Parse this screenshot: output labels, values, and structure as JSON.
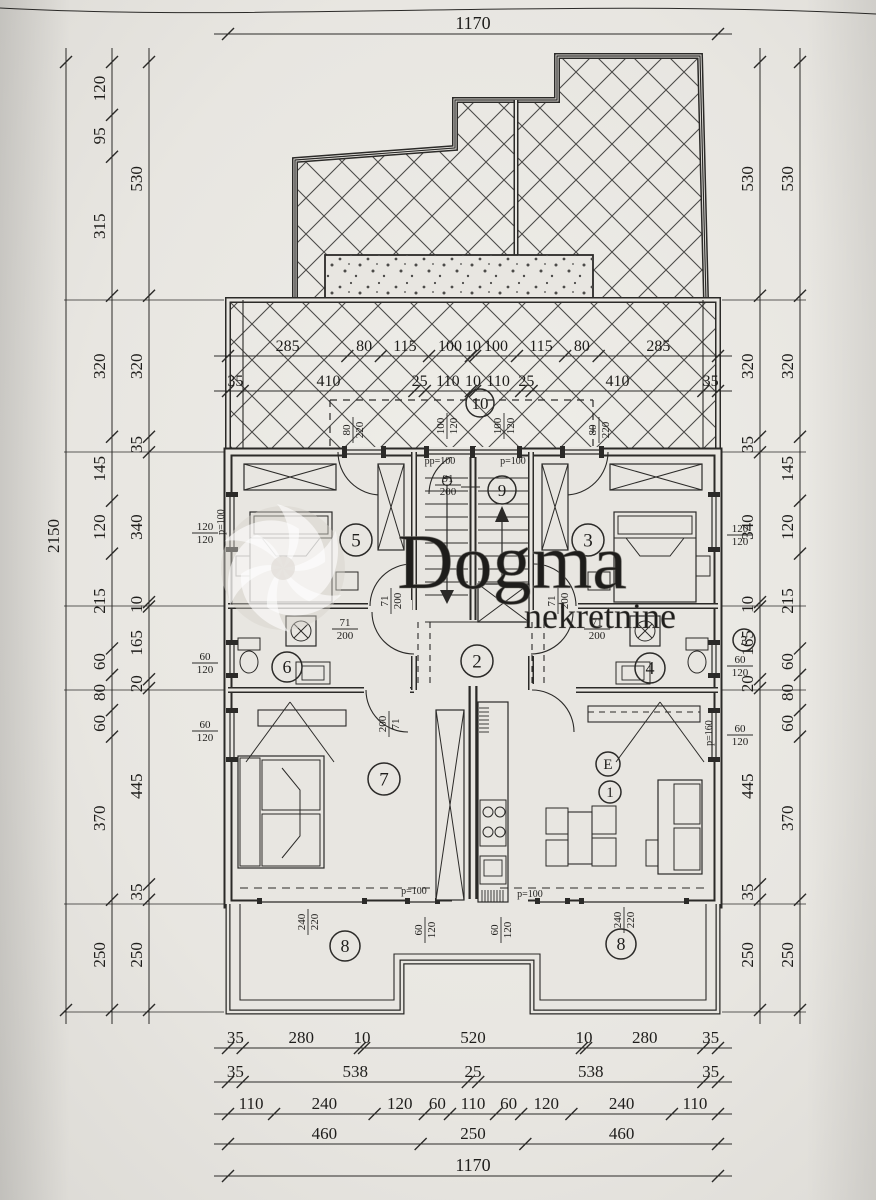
{
  "colors": {
    "paper": "#e8e6e1",
    "paper_light": "#efeee9",
    "ink": "#2b2a28",
    "hatch": "#4c4b49"
  },
  "dimensions": {
    "top_row": [
      "1170"
    ],
    "left_outer": [
      "2150"
    ],
    "left_middle": [
      "120",
      "95",
      "315",
      "320",
      "145",
      "120",
      "215",
      "60",
      "80",
      "60",
      "370",
      "250"
    ],
    "left_inner": [
      "530",
      "320",
      "35",
      "340",
      "10",
      "165",
      "20",
      "445",
      "35",
      "250"
    ],
    "right_inner": [
      "530",
      "320",
      "35",
      "340",
      "10",
      "165",
      "20",
      "445",
      "35",
      "250"
    ],
    "right_outer": [
      "530",
      "320",
      "145",
      "120",
      "215",
      "60",
      "80",
      "60",
      "370",
      "250"
    ],
    "terrace_row_top": [
      "285",
      "80",
      "115",
      "100",
      "10",
      "100",
      "115",
      "80",
      "285"
    ],
    "terrace_row_bottom": [
      "35",
      "410",
      "25",
      "110",
      "10",
      "110",
      "25",
      "410",
      "35"
    ],
    "bottom_row_1": [
      "35",
      "280",
      "10",
      "520",
      "10",
      "280",
      "35"
    ],
    "bottom_row_2": [
      "35",
      "538",
      "25",
      "538",
      "35"
    ],
    "bottom_row_3": [
      "110",
      "240",
      "120",
      "60",
      "110",
      "60",
      "120",
      "240",
      "110"
    ],
    "bottom_row_4": [
      "460",
      "250",
      "460"
    ],
    "bottom_row_5": [
      "1170"
    ]
  },
  "rooms": {
    "terrace_upper": "10",
    "stairs": "9",
    "bedroom_left": "5",
    "bedroom_right": "3",
    "bath_left": "6",
    "hall": "2",
    "bath_right": "4",
    "living_left": "7",
    "unit": "E",
    "living_right": "1",
    "terrace_lower_left": "8",
    "terrace_lower_right": "8",
    "side_marker": "3"
  },
  "openings": {
    "top_window_labels": [
      "80/220",
      "100/120",
      "100/120",
      "80/220"
    ],
    "left_wall_labels": [
      "120/120",
      "60/120",
      "60/120"
    ],
    "right_wall_labels": [
      "120/120",
      "60/120",
      "60/120"
    ],
    "bottom_window_labels": [
      "60/120",
      "60/120"
    ],
    "terrace_door_labels": [
      "240/220",
      "240/220"
    ],
    "interior_door_labels": [
      "71/200",
      "71/200",
      "71/200",
      "71/200",
      "200/71"
    ],
    "stair_label": "91/200",
    "parapet_labels": [
      "pp=100",
      "p=100",
      "p=100",
      "p=100",
      "p=100",
      "p=160"
    ]
  },
  "watermark": {
    "brand": "Dogma",
    "subtitle": "nekretnine"
  }
}
